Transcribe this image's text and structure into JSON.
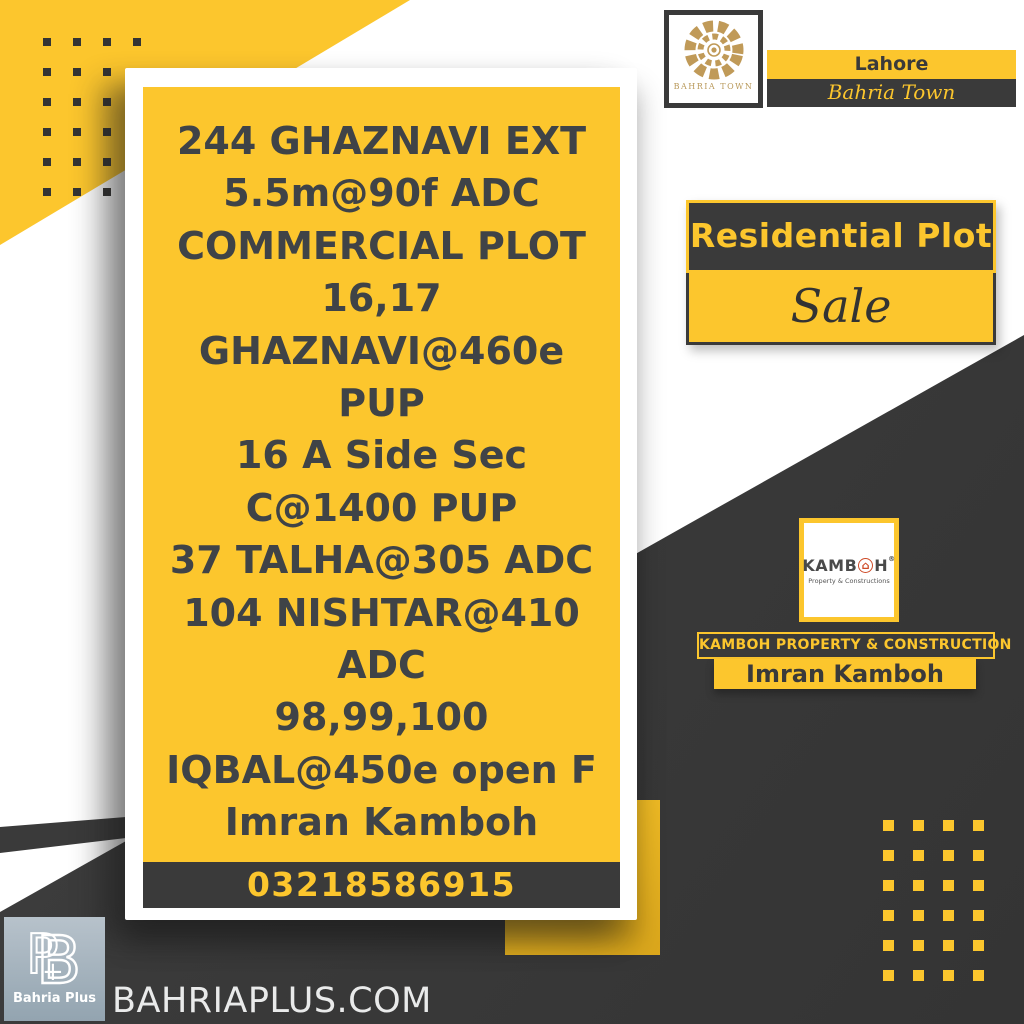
{
  "listing_card": {
    "lines": [
      "244 GHAZNAVI EXT",
      "5.5m@90f ADC",
      "COMMERCIAL PLOT",
      "16,17",
      "GHAZNAVI@460e",
      "PUP",
      "16 A Side Sec",
      "C@1400 PUP",
      "37 TALHA@305 ADC",
      "104 NISHTAR@410",
      "ADC",
      "98,99,100",
      "IQBAL@450e open F",
      "Imran Kamboh"
    ],
    "phone": "03218586915"
  },
  "bahria_town": {
    "logo_caption": "BAHRIA TOWN",
    "city": "Lahore",
    "name": "Bahria Town"
  },
  "badge": {
    "type_label": "Residential Plot",
    "status_label": "Sale"
  },
  "kamboh": {
    "word_prefix": "KAMB",
    "word_suffix": "H",
    "registered": "®",
    "house_glyph": "⌂",
    "logo_subtitle": "Property & Constructions",
    "bar_title": "KAMBOH PROPERTY & CONSTRUCTION",
    "agent_name": "Imran Kamboh"
  },
  "footer": {
    "site": "BAHRIAPLUS.COM",
    "bahria_plus_label": "Bahria Plus"
  },
  "colors": {
    "accent_yellow": "#FCC62D",
    "dark_gray": "#3A3A3A",
    "card_text": "#3F4347",
    "gold": "#C09A58",
    "house_red": "#CE4B28",
    "bp_logo_blue_gray": "#A5B3BE"
  }
}
